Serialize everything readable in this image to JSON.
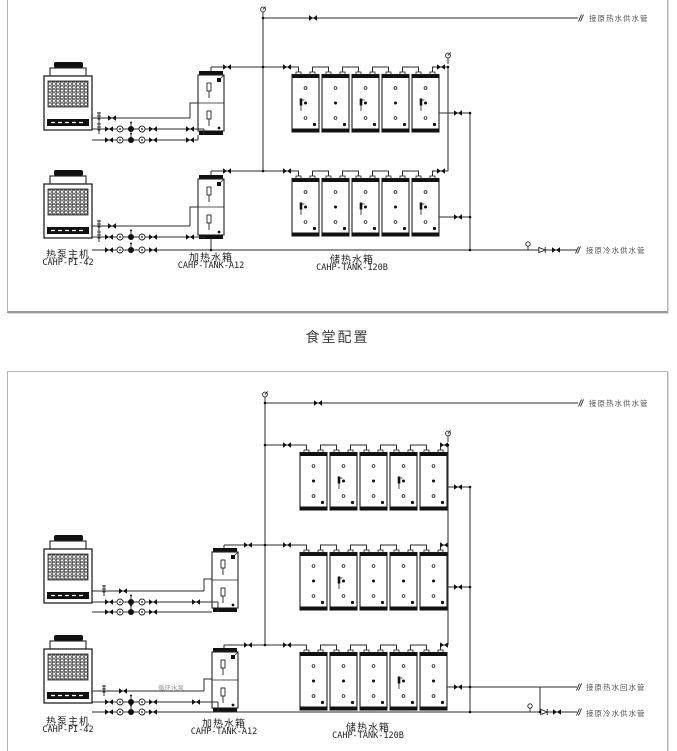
{
  "page": {
    "caption": "食堂配置"
  },
  "colors": {
    "line": "#2b2b2b",
    "panel_border": "#b5b5b5",
    "label_text": "#333333",
    "pipe_label_text": "#555555"
  },
  "diagram_top": {
    "equipment": {
      "heat_pump": {
        "name": "热泵主机",
        "model": "CAHP-PI-42"
      },
      "heating_tank": {
        "name": "加热水箱",
        "model": "CAHP-TANK-A12"
      },
      "storage_tank": {
        "name": "储热水箱",
        "model": "CAHP-TANK-120B"
      }
    },
    "pipe_labels": {
      "hot_supply": "接原热水供水管",
      "cold_supply": "接原冷水供水管"
    }
  },
  "diagram_bottom": {
    "equipment": {
      "heat_pump": {
        "name": "热泵主机",
        "model": "CAHP-PI-42"
      },
      "heating_tank": {
        "name": "加热水箱",
        "model": "CAHP-TANK-A12"
      },
      "storage_tank": {
        "name": "储热水箱",
        "model": "CAHP-TANK-120B"
      }
    },
    "pipe_labels": {
      "hot_supply": "接原热水供水管",
      "hot_return": "接原热水回水管",
      "cold_supply": "接原冷水供水管"
    },
    "pump_label": "循环水泵"
  }
}
